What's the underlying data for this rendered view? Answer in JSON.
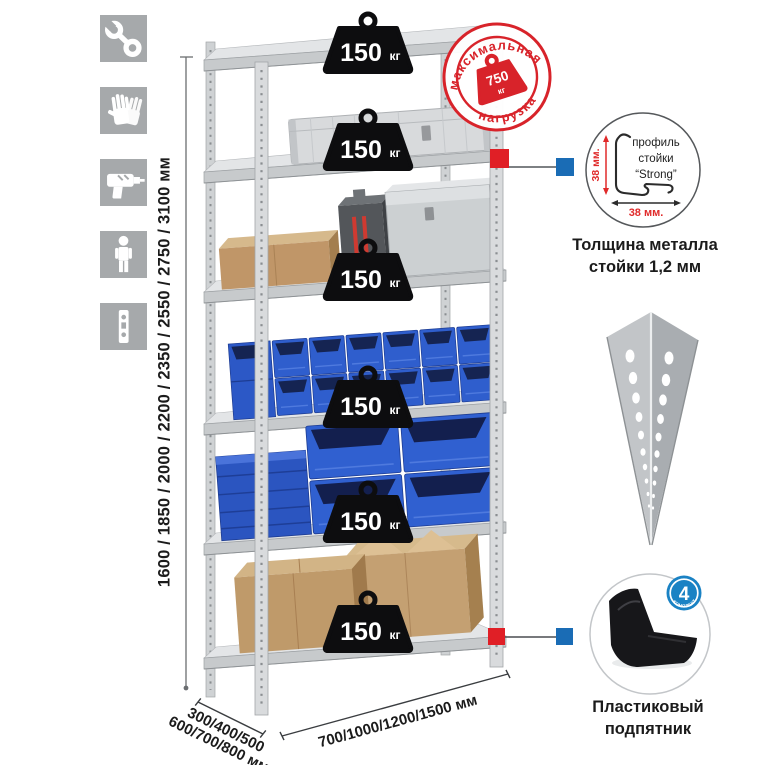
{
  "left_icons": [
    {
      "name": "wrench"
    },
    {
      "name": "gloves"
    },
    {
      "name": "drill"
    },
    {
      "name": "person"
    },
    {
      "name": "perforated-profile"
    }
  ],
  "dimensions": {
    "height": "1600 / 1850 / 2000 / 2200 / 2350 / 2550 / 2750 / 3100 мм",
    "depth_line1": "300/400/500",
    "depth_line2": "600/700/800 мм",
    "width": "700/1000/1200/1500 мм"
  },
  "rack": {
    "shelf_count": 6,
    "weights": [
      {
        "value": "150",
        "unit": "кг"
      },
      {
        "value": "150",
        "unit": "кг"
      },
      {
        "value": "150",
        "unit": "кг"
      },
      {
        "value": "150",
        "unit": "кг"
      },
      {
        "value": "150",
        "unit": "кг"
      },
      {
        "value": "150",
        "unit": "кг"
      }
    ]
  },
  "max_load_stamp": {
    "arc_top": "максимальная",
    "arc_bottom": "нагрузка",
    "value": "750",
    "unit": "кг"
  },
  "profile_detail": {
    "title_line1": "профиль",
    "title_line2": "стойки",
    "title_line3": "“Strong”",
    "dim_vertical": "38 мм.",
    "dim_horizontal": "38 мм.",
    "caption_line1": "Толщина металла",
    "caption_line2": "стойки 1,2 мм"
  },
  "foot_detail": {
    "badge_number": "4",
    "badge_text": "В КОМПЛЕКТЕ",
    "caption_line1": "Пластиковый",
    "caption_line2": "подпятник"
  },
  "colors": {
    "accent_red": "#d8232a",
    "marker_red": "#e01f26",
    "marker_blue": "#1a6cb5",
    "badge_blue": "#1a82c4",
    "bin_blue": "#2f5ecd",
    "metal_gray": "#d2d5d7",
    "icon_gray": "#a6a9ab",
    "cardboard": "#c2996a",
    "weight_black": "#0d0d0f"
  }
}
